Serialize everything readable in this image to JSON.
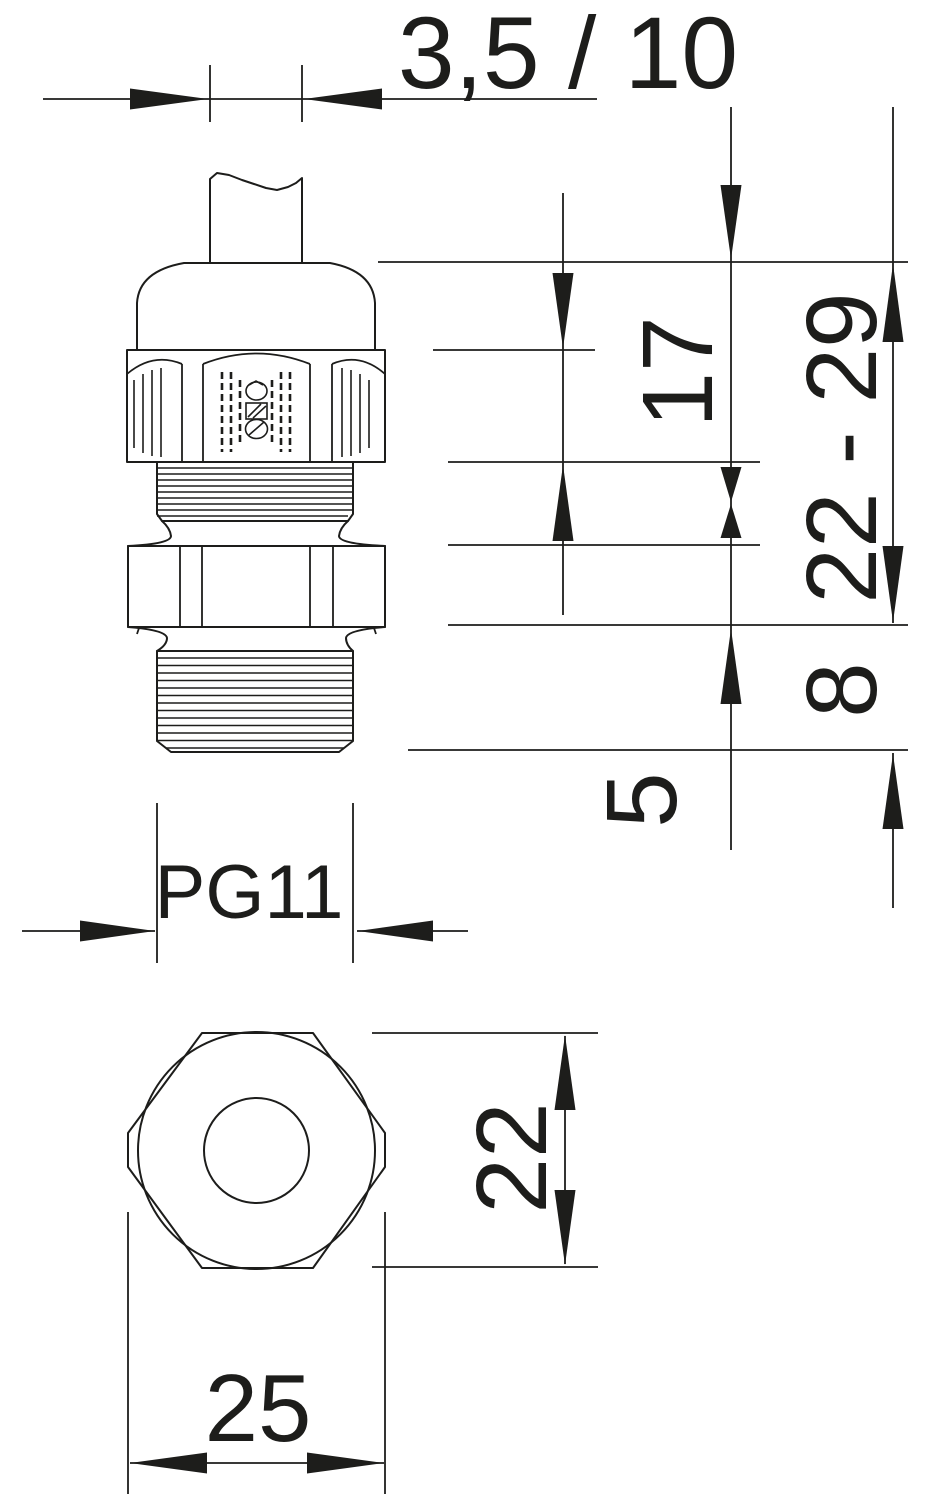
{
  "drawing": {
    "background": "#ffffff",
    "line_color": "#1d1d1b",
    "description": "Cable gland dimension drawing, side view and front view",
    "dimensions": {
      "clamping_range": "3,5 / 10",
      "upper_section": "17",
      "height_range": "22 - 29",
      "thread_length": "8",
      "tip_length": "5",
      "thread_size": "PG11",
      "across_flats": "22",
      "across_corners": "25"
    }
  }
}
